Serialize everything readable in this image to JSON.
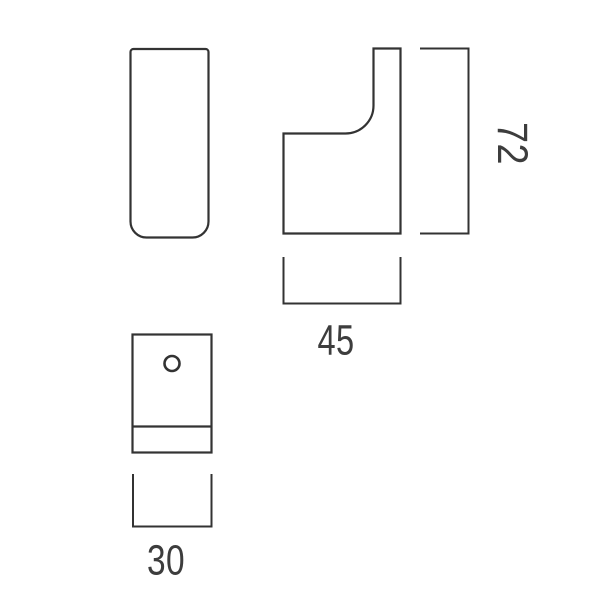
{
  "drawing": {
    "background_color": "#ffffff",
    "line_color": "#333333",
    "text_color": "#3d3d3d",
    "dimensions": [
      {
        "id": "height",
        "value": "72",
        "orientation": "vertical"
      },
      {
        "id": "depth",
        "value": "45",
        "orientation": "horizontal"
      },
      {
        "id": "width",
        "value": "30",
        "orientation": "horizontal"
      }
    ]
  }
}
